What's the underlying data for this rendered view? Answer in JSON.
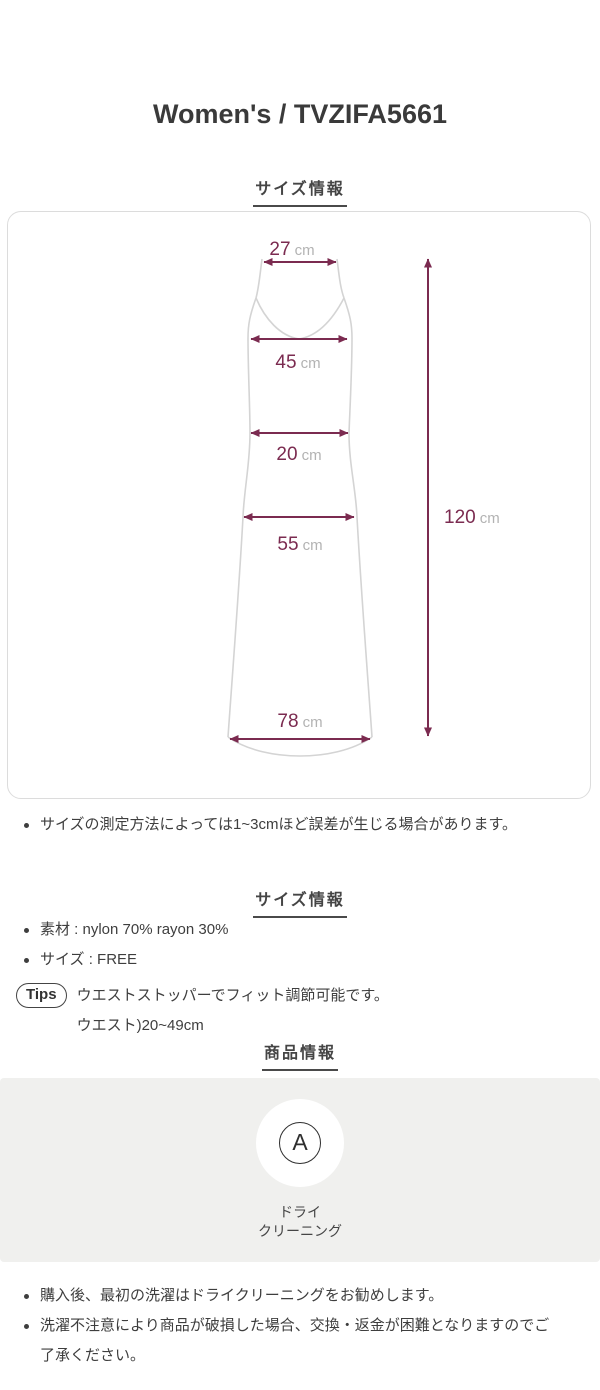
{
  "page": {
    "title": "Women's / TVZIFA5661"
  },
  "sections": {
    "size_header_1": "サイズ情報",
    "size_header_2": "サイズ情報",
    "product_header": "商品情報"
  },
  "diagram": {
    "measurements": [
      {
        "name": "shoulder-strap-width",
        "value": "27",
        "unit": "cm"
      },
      {
        "name": "bust-width",
        "value": "45",
        "unit": "cm"
      },
      {
        "name": "waist-width",
        "value": "20",
        "unit": "cm"
      },
      {
        "name": "hip-width",
        "value": "55",
        "unit": "cm"
      },
      {
        "name": "hem-width",
        "value": "78",
        "unit": "cm"
      },
      {
        "name": "total-length",
        "value": "120",
        "unit": "cm"
      }
    ]
  },
  "size_note": "サイズの測定方法によっては1~3cmほど誤差が生じる場合があります。",
  "size_details": [
    "素材 : nylon 70% rayon 30%",
    "サイズ : FREE"
  ],
  "tips": {
    "label": "Tips",
    "text": "ウエストストッパーでフィット調節可能です。",
    "sub_text": "ウエスト)20~49cm"
  },
  "care": {
    "symbol_letter": "A",
    "label_line1": "ドライ",
    "label_line2": "クリーニング"
  },
  "product_notes": [
    "購入後、最初の洗濯はドライクリーニングをお勧めします。",
    "洗濯不注意により商品が破損した場合、交換・返金が困難となりますのでご了承ください。"
  ],
  "colors": {
    "accent": "#7b2b50",
    "unit_gray": "#b3b3b3",
    "outline_gray": "#d4d4d4",
    "panel_bg": "#f0f0ee",
    "text": "#3e3e3e"
  }
}
